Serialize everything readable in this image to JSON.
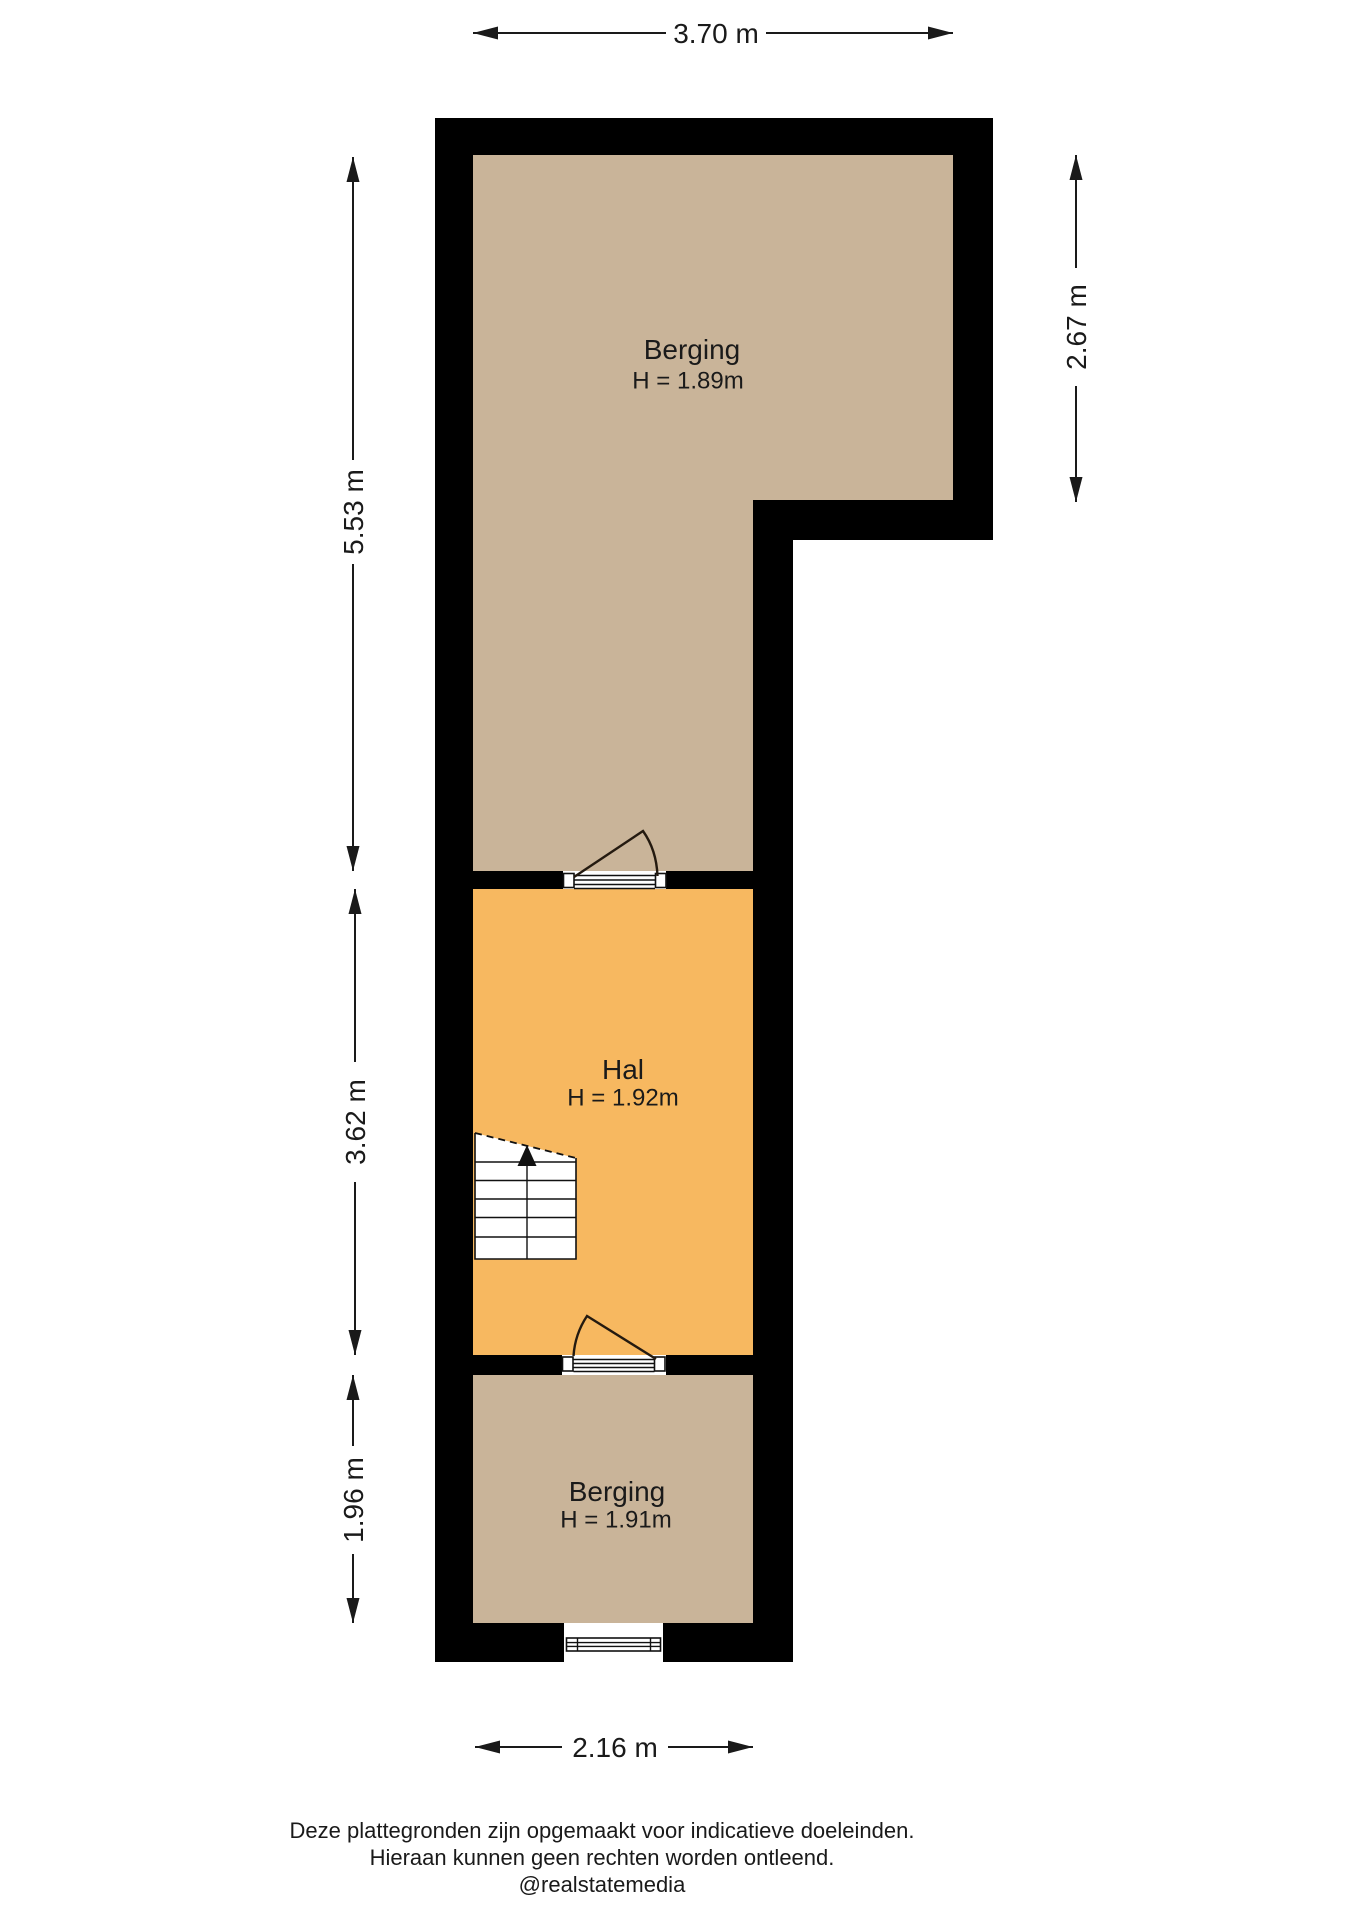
{
  "rooms": [
    {
      "name": "Berging",
      "height": "H = 1.89m"
    },
    {
      "name": "Hal",
      "height": "H = 1.92m"
    },
    {
      "name": "Berging",
      "height": "H = 1.91m"
    }
  ],
  "dimensions": {
    "top": "3.70 m",
    "left_upper": "5.53 m",
    "left_middle": "3.62 m",
    "left_lower": "1.96 m",
    "right": "2.67 m",
    "bottom": "2.16 m"
  },
  "footer": {
    "line1": "Deze plattegronden zijn opgemaakt voor indicatieve doeleinden.",
    "line2": "Hieraan kunnen geen rechten worden ontleend.",
    "line3": "@realstatemedia"
  },
  "colors": {
    "wall": "#000000",
    "storage_fill": "#C9B499",
    "hall_fill": "#F7B860",
    "background": "#FFFFFF"
  }
}
